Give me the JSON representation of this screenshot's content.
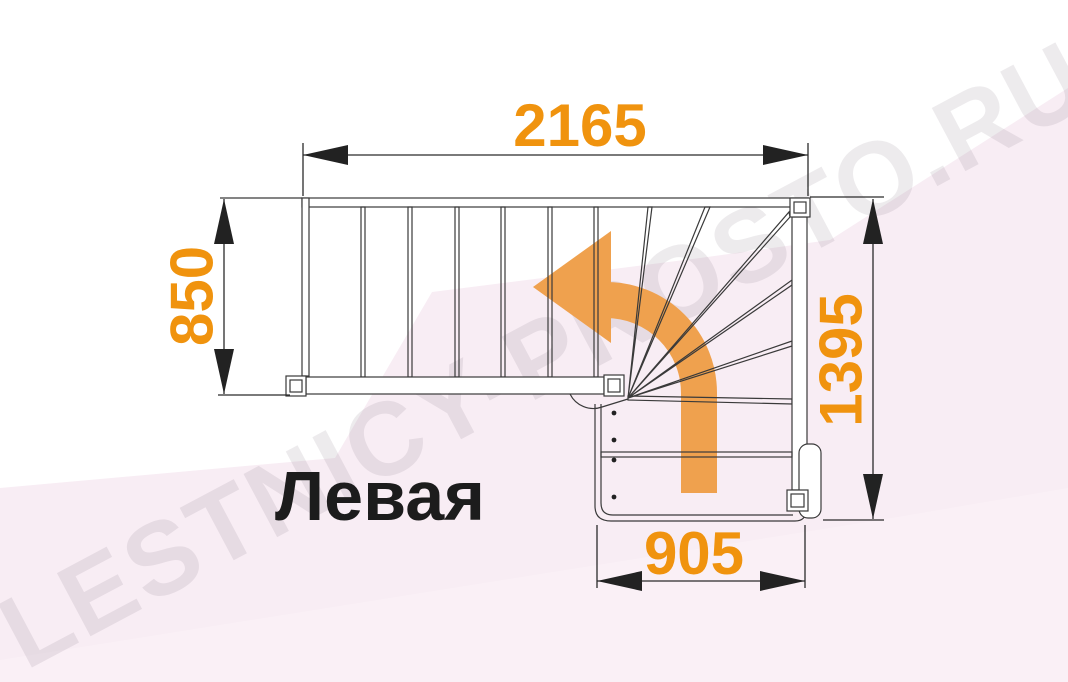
{
  "diagram": {
    "label": "Левая",
    "watermark": "LESTNICY-PROSTO.RU",
    "dimensions": {
      "top_width": "2165",
      "left_depth": "850",
      "right_depth": "1395",
      "bottom_width": "905"
    }
  },
  "colors": {
    "dimension_orange": "#F0930E",
    "arrow_orange": "#EFA14E",
    "line_dark": "#3A3A3A",
    "label_black": "#1C1C1C",
    "background_pink": "#F8EDF4",
    "background_pink_light": "#FAF0F6",
    "watermark_gray": "rgba(95,75,95,0.11)"
  }
}
